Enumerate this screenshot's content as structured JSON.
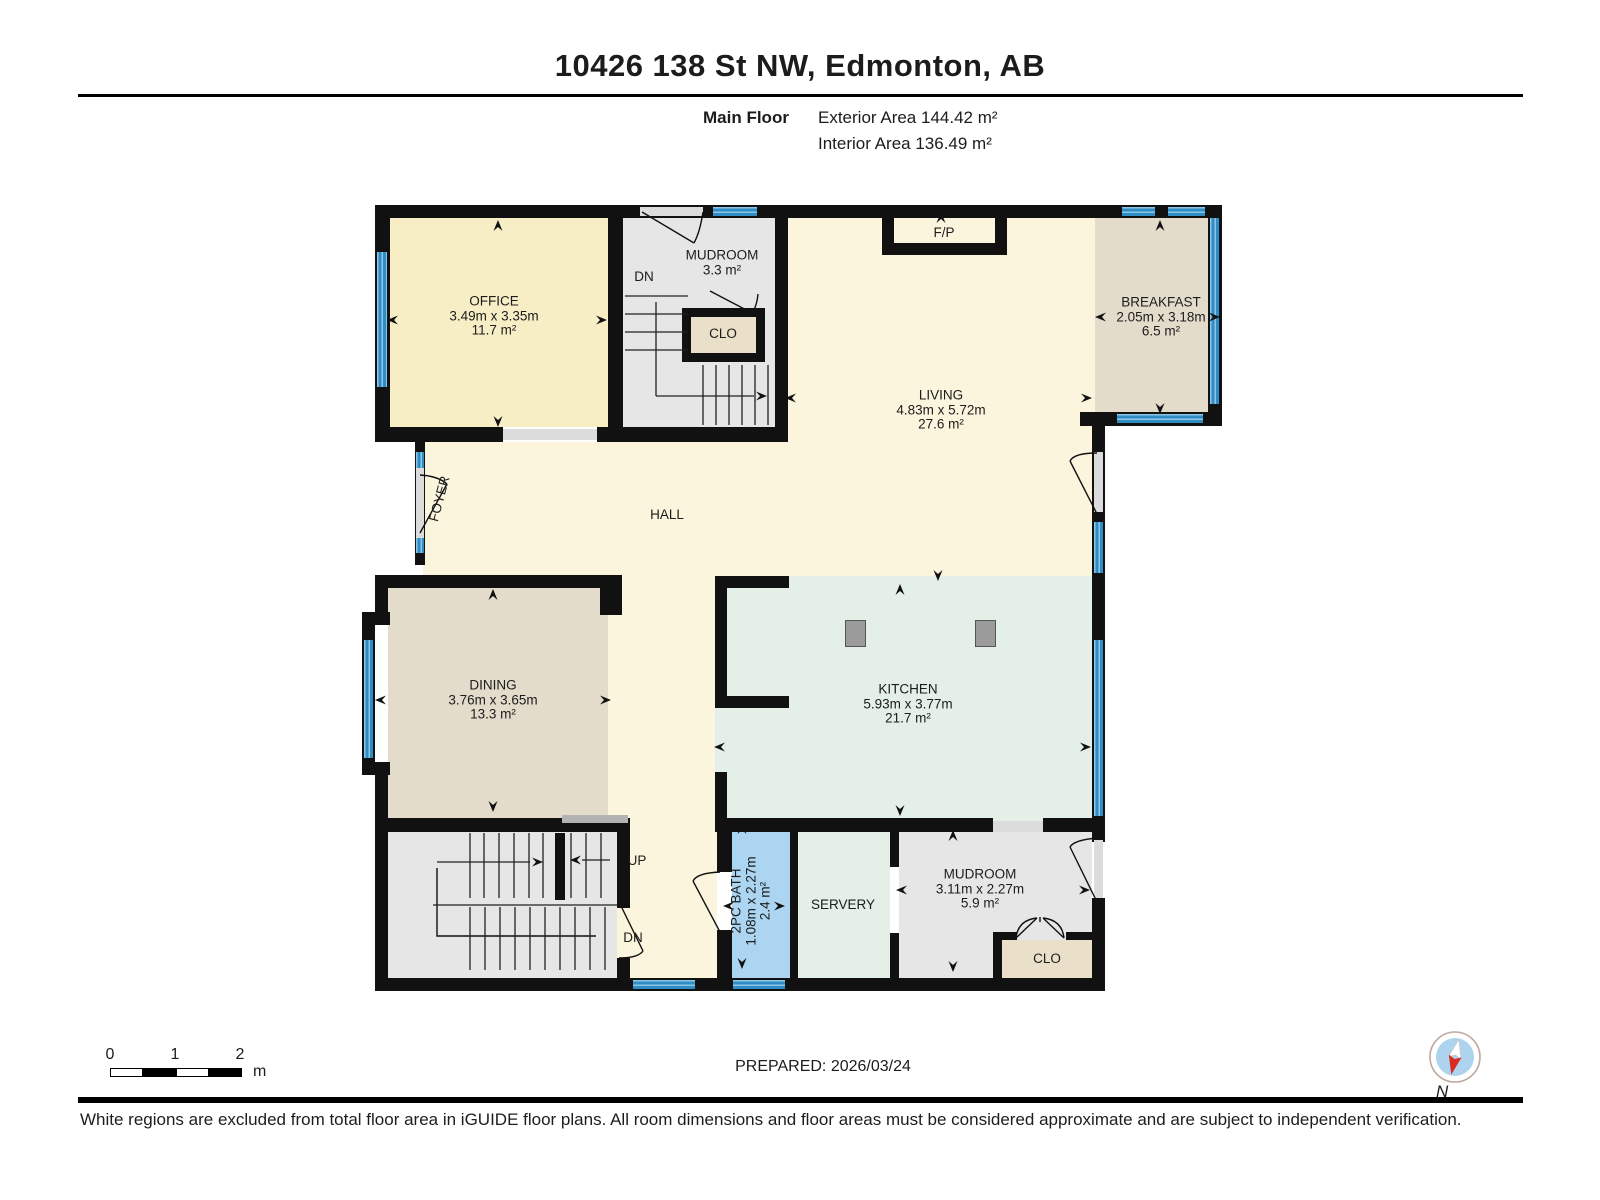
{
  "header": {
    "title": "10426 138 St NW, Edmonton, AB",
    "floor_label": "Main Floor",
    "exterior_area": "Exterior Area 144.42 m²",
    "interior_area": "Interior Area 136.49 m²"
  },
  "rooms": {
    "office": {
      "name": "OFFICE",
      "dims": "3.49m x 3.35m",
      "area": "11.7 m²"
    },
    "mudroom_top": {
      "name": "MUDROOM",
      "area": "3.3 m²"
    },
    "clo_top": {
      "name": "CLO"
    },
    "fireplace": {
      "name": "F/P"
    },
    "living": {
      "name": "LIVING",
      "dims": "4.83m x 5.72m",
      "area": "27.6 m²"
    },
    "breakfast": {
      "name": "BREAKFAST",
      "dims": "2.05m x 3.18m",
      "area": "6.5 m²"
    },
    "foyer": {
      "name": "FOYER"
    },
    "hall": {
      "name": "HALL"
    },
    "dining": {
      "name": "DINING",
      "dims": "3.76m x 3.65m",
      "area": "13.3 m²"
    },
    "kitchen": {
      "name": "KITCHEN",
      "dims": "5.93m x 3.77m",
      "area": "21.7 m²"
    },
    "bath": {
      "name": "2PC BATH",
      "dims": "1.08m x 2.27m",
      "area": "2.4 m²"
    },
    "servery": {
      "name": "SERVERY"
    },
    "mudroom_bottom": {
      "name": "MUDROOM",
      "dims": "3.11m x 2.27m",
      "area": "5.9 m²"
    },
    "clo_bottom": {
      "name": "CLO"
    }
  },
  "stairs": {
    "up_label": "UP",
    "dn_label_top": "DN",
    "dn_label_bottom": "DN"
  },
  "scale_bar": {
    "tick_0": "0",
    "tick_1": "1",
    "tick_2": "2",
    "unit": "m"
  },
  "compass": {
    "north_label": "N"
  },
  "footer": {
    "prepared_label": "PREPARED: 2026/03/24",
    "disclaimer": "White regions are excluded from total floor area in iGUIDE floor plans. All room dimensions and floor areas must be considered approximate and are subject to independent verification."
  },
  "colors": {
    "wall": "#111111",
    "window_blue": "#2f8cc4",
    "office_yellow": "#f8eec6",
    "cream": "#fcf5de",
    "tan": "#e3dcca",
    "mint": "#e4efe7",
    "room_gray": "#e6e6e6",
    "closet_beige": "#eadfc8",
    "bath_blue": "#abd5f0",
    "compass_red": "#d92b21",
    "compass_blue": "#aed3ee"
  }
}
